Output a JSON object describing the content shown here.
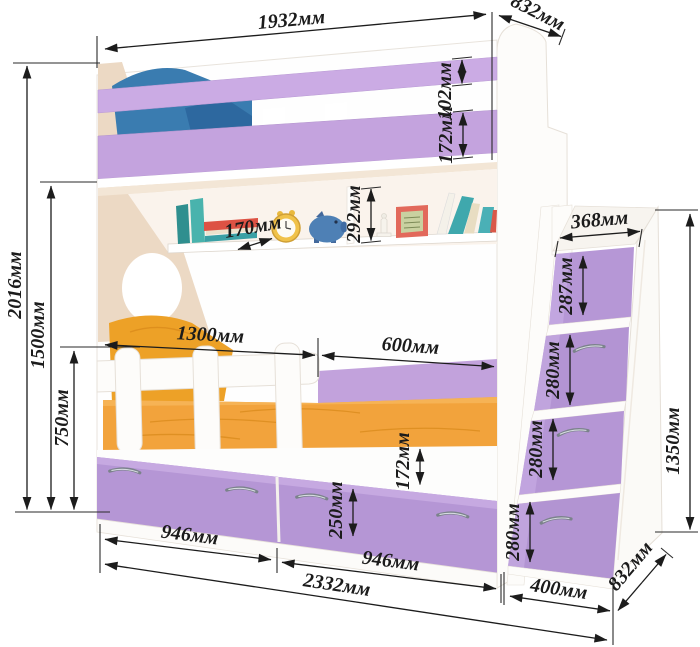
{
  "dimensions": {
    "bed_top_width": "1932мм",
    "bed_depth": "832мм",
    "top_rail_height": "102мм",
    "second_rail_height": "172мм",
    "shelf_opening_height": "292мм",
    "shelf_depth": "170мм",
    "overall_height": "2016мм",
    "upper_bunk_height": "1500мм",
    "guard_rail_height": "750мм",
    "lower_bed_section": "1300мм",
    "foot_section": "600мм",
    "ladder_top_width": "368мм",
    "ladder_step1_height": "287мм",
    "ladder_step2_height": "280мм",
    "ladder_step3_height": "280мм",
    "ladder_step4_height": "280мм",
    "ladder_height": "1350мм",
    "base_band_height": "172мм",
    "drawer_front_height": "250мм",
    "left_drawer_width": "946мм",
    "right_drawer_width": "946мм",
    "overall_width": "2332мм",
    "ladder_width": "400мм",
    "ladder_depth": "832мм"
  },
  "colors": {
    "rail_purple": "#cbabe4",
    "drawer_purple": "#b596d5",
    "step_purple": "#b697d6",
    "headboard_cream": "#ecd9c4",
    "mattress_orange": "#f2a33c",
    "pillow_orange": "#eda127",
    "pillow_blue": "#3a7cb0",
    "dimension_ink": "#1c1c1c",
    "furniture_white": "#ffffff"
  },
  "shelf_items": [
    "books",
    "alarm-clock",
    "piggy-bank",
    "candlestick",
    "photo-frame",
    "books"
  ]
}
